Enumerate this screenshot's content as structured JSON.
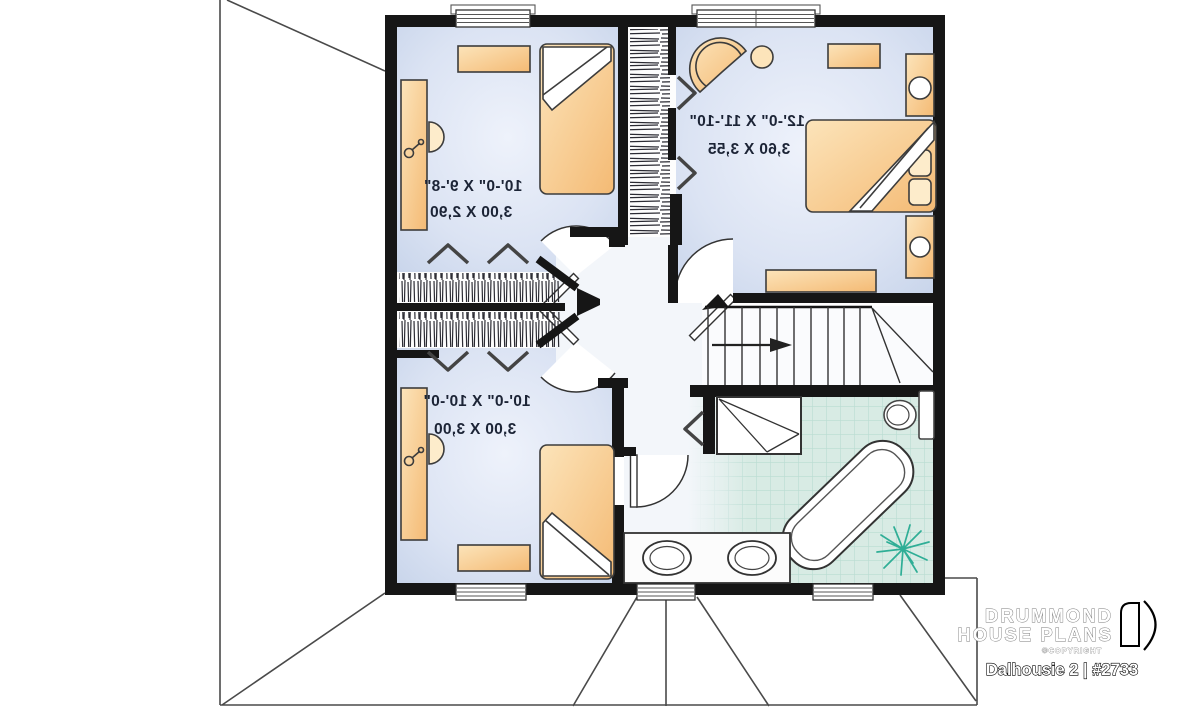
{
  "rooms": [
    {
      "id": "bedroom-top-left",
      "imperial": "10'-0\" X 9'-8\"",
      "metric": "3,00 X 2,90"
    },
    {
      "id": "master-bedroom",
      "imperial": "12'-0\" X 11'-10\"",
      "metric": "3,60 X 3,55"
    },
    {
      "id": "bedroom-bottom-left",
      "imperial": "10'-0\" X 10'-0\"",
      "metric": "3,00 X 3,00"
    }
  ],
  "branding": {
    "company_line1": "DRUMMOND",
    "company_line2": "HOUSE PLANS",
    "copyright": "©COPYRIGHT",
    "model": "Dalhousie 2 | #2733"
  },
  "colors": {
    "wall": "#161616",
    "bedroom_floor_edge": "#c2d0e8",
    "bedroom_floor_center": "#eef2fb",
    "hall_floor": "#f3f6fa",
    "tile": "#d8ebe4",
    "tile_line": "#b9dcd2",
    "furniture_light": "#fce4ba",
    "furniture_dark": "#f4ba74",
    "plant": "#2fae96"
  }
}
